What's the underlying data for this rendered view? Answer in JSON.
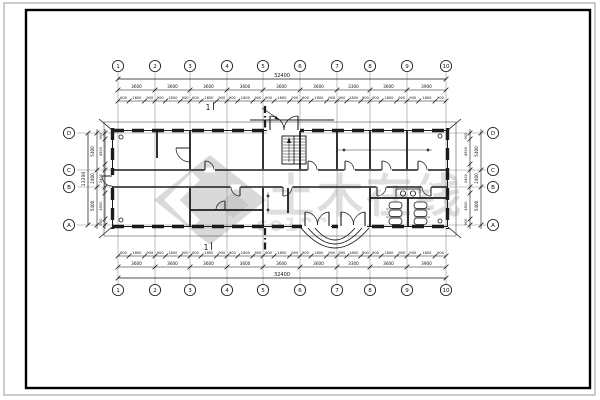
{
  "page": {
    "background": "#ffffff",
    "outer_border_color": "#999999",
    "inner_border_color": "#000000",
    "line_color": "#1c1c1c",
    "grid_line_color": "#8a8a8a"
  },
  "watermark": {
    "main_text": "土木在线",
    "sub_text": "co188",
    "logo_color": "#d9d9d9",
    "logo_dark_color": "#c9c9c9",
    "text_color": "#dedede"
  },
  "section_marker": {
    "top_label": "1",
    "bottom_label": "1"
  },
  "grid_bubbles": {
    "top": [
      "1",
      "2",
      "3",
      "4",
      "5",
      "6",
      "7",
      "8",
      "9",
      "10"
    ],
    "bottom": [
      "1",
      "2",
      "3",
      "4",
      "5",
      "6",
      "7",
      "8",
      "9",
      "10"
    ],
    "left": [
      "D",
      "C",
      "B",
      "A"
    ],
    "right": [
      "D",
      "C",
      "B",
      "A"
    ]
  },
  "dimensions": {
    "top": {
      "overall": "32400",
      "bays": [
        "3600",
        "3600",
        "3600",
        "3600",
        "3600",
        "3600",
        "3300",
        "3600",
        "3900"
      ],
      "fine_pattern": [
        "900",
        "1800",
        "900"
      ]
    },
    "bottom": {
      "overall": "32400",
      "bays": [
        "3600",
        "3600",
        "3600",
        "3600",
        "3600",
        "3600",
        "3300",
        "3600",
        "3900"
      ],
      "fine_pattern": [
        "900",
        "1800",
        "900"
      ]
    },
    "left": {
      "overall": "13200",
      "bays": [
        "5400",
        "2400",
        "5400"
      ],
      "fine": [
        "900",
        "4500",
        "2400",
        "4500",
        "900"
      ]
    },
    "right": {
      "bays": [
        "5400",
        "2400",
        "5400"
      ],
      "fine": [
        "900",
        "4500",
        "2400",
        "4500",
        "900"
      ]
    }
  }
}
